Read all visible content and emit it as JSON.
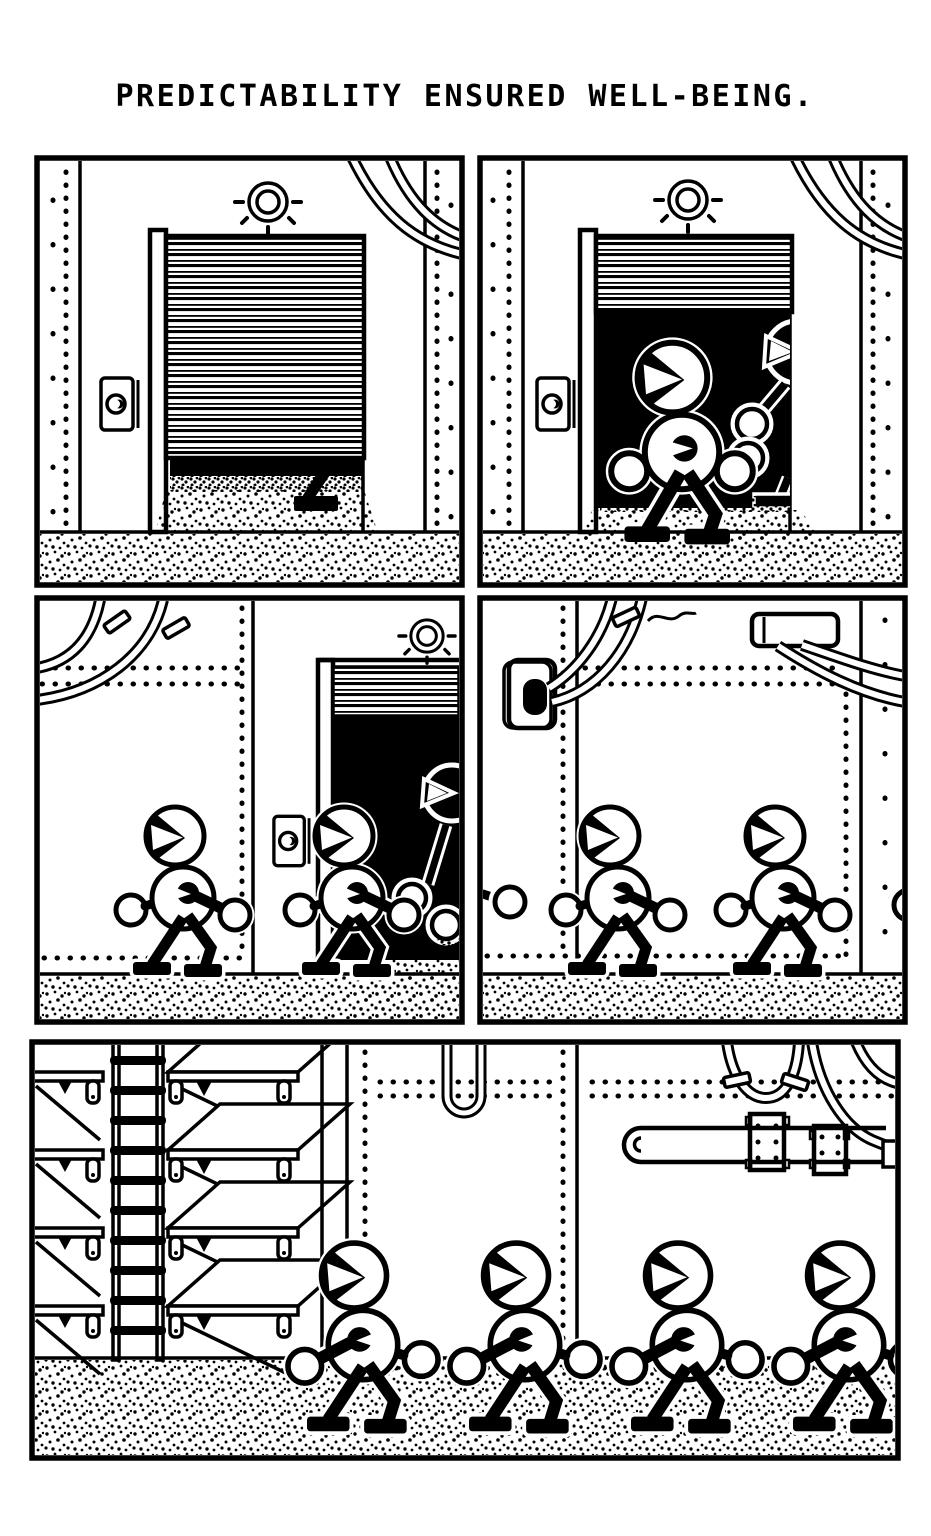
{
  "page": {
    "width": 931,
    "height": 1536,
    "background": "#ffffff",
    "ink": "#000000"
  },
  "caption": {
    "text": "PREDICTABILITY ENSURED WELL-BEING."
  },
  "panels": [
    {
      "id": "panel-1",
      "label": "Closed roller shutter door with lamp above; sand spills under the door and a single black boot pokes out",
      "robots_full": 0,
      "robots_partial": 1,
      "props": [
        "roller-door",
        "lamp",
        "call-button",
        "riveted-columns",
        "corner-pipes",
        "sand-mound",
        "boot"
      ]
    },
    {
      "id": "panel-2",
      "label": "Roller door rolled up; a robot steps out of the dark doorway while a second robot follows behind",
      "robots_full": 1,
      "robots_partial": 1,
      "props": [
        "roller-door",
        "lamp",
        "call-button",
        "riveted-columns",
        "corner-pipes",
        "dark-doorway",
        "sand-mound"
      ]
    },
    {
      "id": "panel-3",
      "label": "Two robots march left past a small roller door where a third robot emerges from the dark",
      "robots_full": 2,
      "robots_partial": 1,
      "props": [
        "roller-door",
        "lamp",
        "call-button",
        "riveted-wall",
        "corner-pipes",
        "pipe-clamps",
        "dark-doorway"
      ]
    },
    {
      "id": "panel-4",
      "label": "Two robots march left along a riveted corridor wall with a conduit plate and wall pipes",
      "robots_full": 2,
      "robots_partial": 2,
      "props": [
        "riveted-wall",
        "conduit-plate",
        "cable",
        "wall-bracket",
        "pipes"
      ]
    },
    {
      "id": "panel-5",
      "label": "Four robots march left past empty shelving units, a ladder, a U-pipe and a bolted wall pipe",
      "robots_full": 4,
      "robots_partial": 0,
      "props": [
        "shelving-units",
        "ladder",
        "riveted-wall",
        "u-pipe",
        "bolted-pipe",
        "pipe-clamps"
      ]
    }
  ],
  "characters": {
    "type": "round-headed robot walker",
    "facing": "left",
    "total_full_visible": 9,
    "total_partial": 5
  }
}
